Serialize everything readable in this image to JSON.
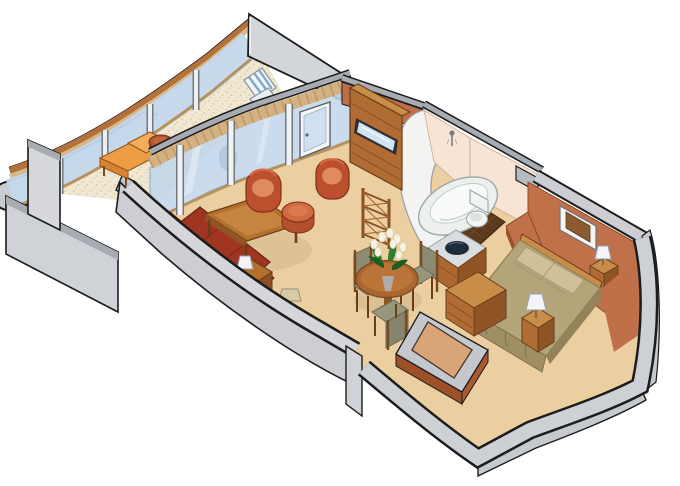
{
  "title": "Suite floor plan — isometric cutaway illustration",
  "palette": {
    "background": "#ffffff",
    "outline": "#1c1c1c",
    "cutaway_wall": "#cfd2d6",
    "cutaway_wall_mid": "#c4c7cc",
    "wall_edge_gray": "#a7acb3",
    "interior_wall": "#c0714a",
    "interior_wall_dark": "#9c5129",
    "floor_tan": "#ebcfa0",
    "veranda_floor": "#f0e8d3",
    "veranda_speckle": "#d9cba6",
    "glass_blue": "#bfd5ea",
    "glass_door": "#cfe0f0",
    "rail_cap_orange": "#b5713a",
    "rail_wood": "#d7b988",
    "transom_wood": "#d4b183",
    "wood": "#b06c33",
    "wood_light": "#c98d4a",
    "wood_dark": "#8f5527",
    "sofa_red": "#a03522",
    "sofa_red_dark": "#8f2e1b",
    "upholstery_rust": "#bb4f2e",
    "upholstery_rust_light": "#e08a5f",
    "lounge_orange": "#ef9d45",
    "bed_khaki": "#b4a479",
    "pillow_khaki": "#cfc098",
    "bed_skirt": "#a08f62",
    "bath_wall_pink": "#f8e4d4",
    "bath_white": "#f3f4f2",
    "bath_tile_brown": "#5d3a1d",
    "basin_dark": "#1f2d3a",
    "lamp_shade_white": "#f2f4f7",
    "lamp_shade_beige": "#d8cca8",
    "tv_screen": "#cfe4f0",
    "chair_seat_olive": "#97977d",
    "foliage_green": "#2e7d32",
    "flower_white": "#f6f3e2",
    "stripe_blue": "#7fa8cc"
  },
  "rooms": {
    "veranda": {
      "name": "veranda",
      "furniture": [
        "chaise lounge",
        "round side table",
        "striped deck chair"
      ]
    },
    "living_room": {
      "name": "living room",
      "furniture": [
        "three-seat sofa",
        "coffee table",
        "barrel chair",
        "barrel chair",
        "round ottoman",
        "side table with lamp",
        "floor lamp",
        "tv cabinet with drawers",
        "etagere shelf"
      ]
    },
    "dining_area": {
      "name": "dining area",
      "furniture": [
        "round dining table",
        "dining chair",
        "dining chair",
        "dining chair",
        "white flower bouquet"
      ]
    },
    "bathroom": {
      "name": "bathroom",
      "furniture": [
        "oval bathtub",
        "toilet",
        "wall shower",
        "vanity with dark basin"
      ]
    },
    "bedroom": {
      "name": "bedroom",
      "furniture": [
        "double bed",
        "nightstand with lamp",
        "nightstand with lamp",
        "dresser",
        "framed wall art"
      ]
    },
    "entry": {
      "name": "entry closet",
      "furniture": [
        "low partition walls"
      ]
    }
  }
}
